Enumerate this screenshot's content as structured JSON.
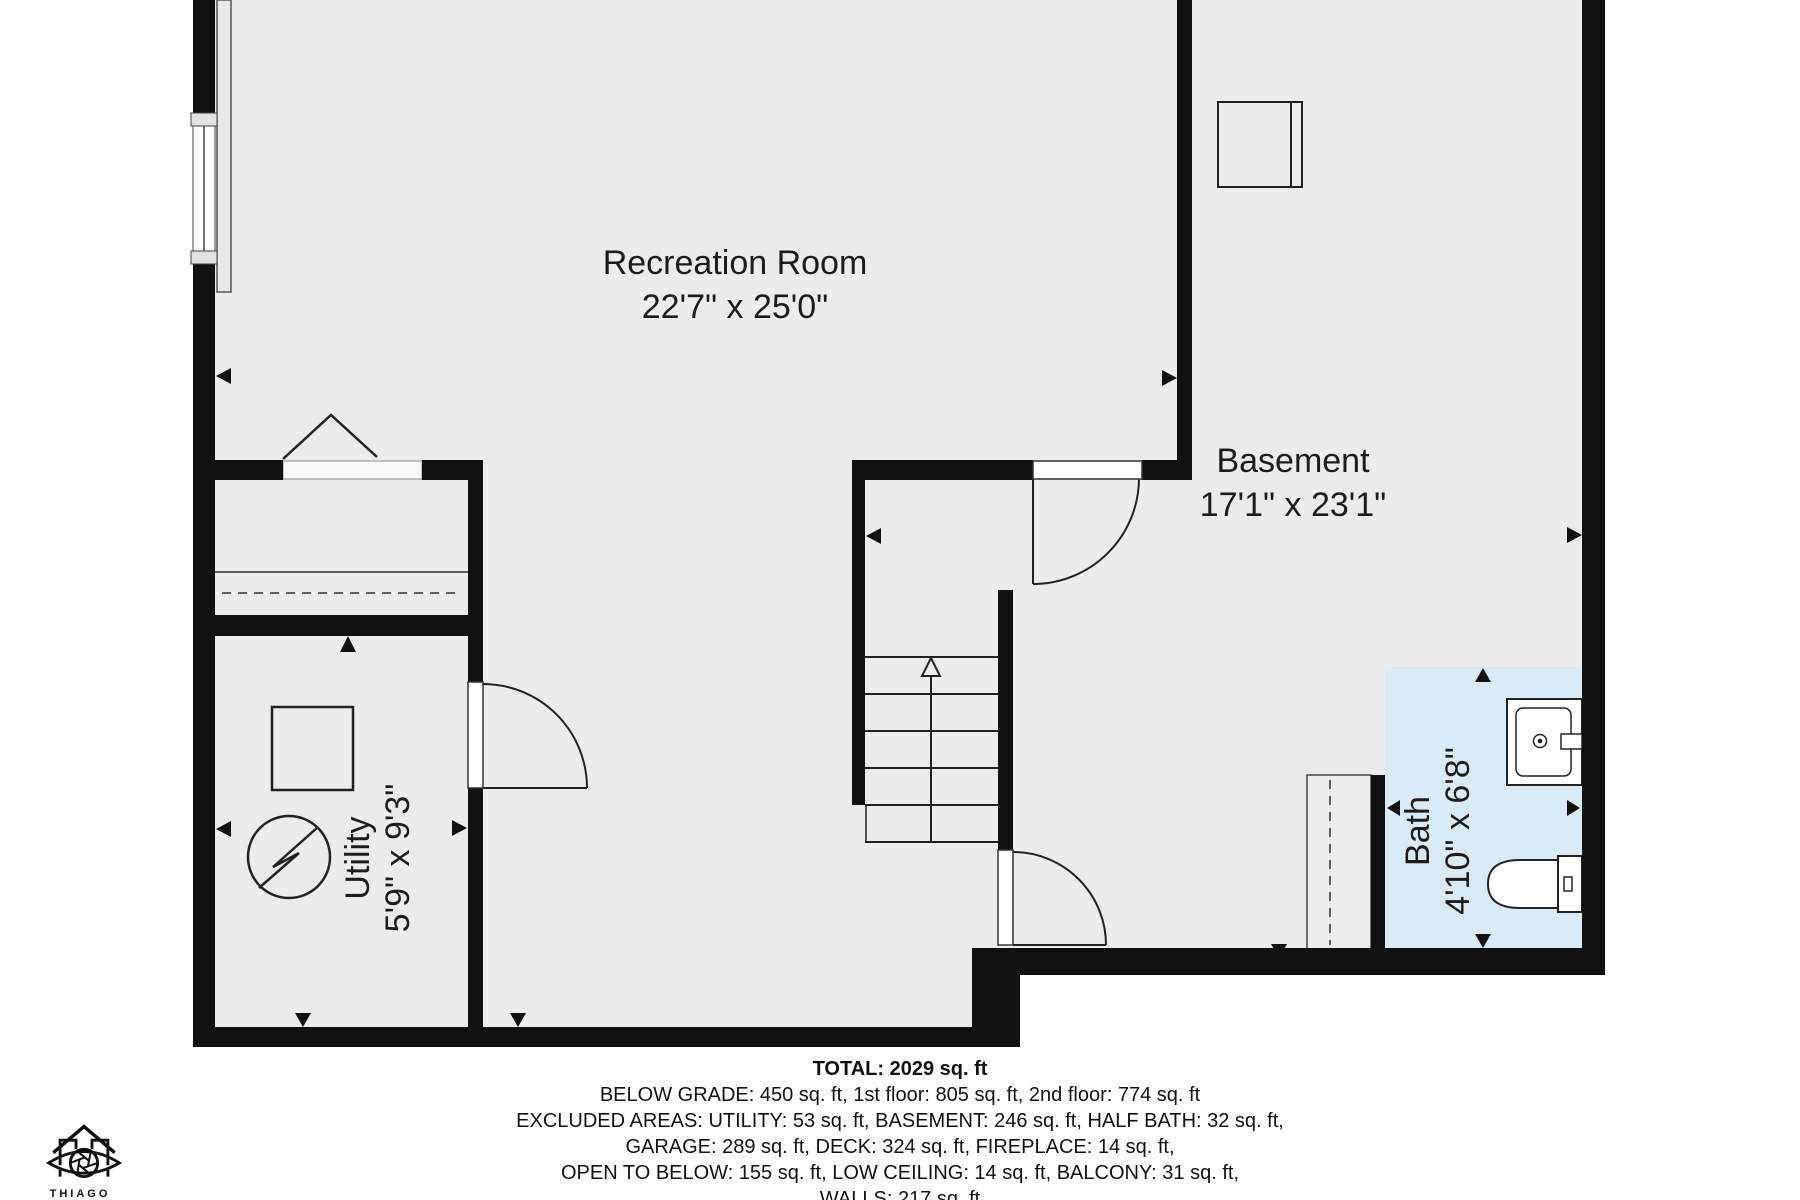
{
  "plan": {
    "rooms": [
      {
        "name": "Recreation Room",
        "dimensions": "22'7\" x 25'0\""
      },
      {
        "name": "Basement",
        "dimensions": "17'1\" x 23'1\""
      },
      {
        "name": "Utility",
        "dimensions": "5'9\" x 9'3\""
      },
      {
        "name": "Bath",
        "dimensions": "4'10\" x 6'8\""
      }
    ],
    "summary": {
      "total": "TOTAL: 2029 sq. ft",
      "line2": "BELOW GRADE: 450 sq. ft, 1st floor: 805 sq. ft, 2nd floor: 774 sq. ft",
      "line3": "EXCLUDED AREAS: UTILITY: 53 sq. ft, BASEMENT: 246 sq. ft, HALF BATH: 32 sq. ft,",
      "line4": "GARAGE: 289 sq. ft, DECK: 324 sq. ft, FIREPLACE: 14 sq. ft,",
      "line5": "OPEN TO BELOW: 155 sq. ft, LOW CEILING: 14 sq. ft, BALCONY: 31 sq. ft,",
      "line6": "WALLS: 217 sq. ft"
    },
    "branding": {
      "logo_text": "THIAGO"
    },
    "colors": {
      "wall": "#111111",
      "floor": "#ececec",
      "bath_floor": "#d9ebf7",
      "line": "#222222",
      "background": "#ffffff"
    },
    "fixtures": [
      "window",
      "fireplace",
      "closet-dashed-rod",
      "stairs-up",
      "door",
      "electrical-panel",
      "furnace-fan",
      "duct-unit",
      "support-post",
      "sink",
      "toilet"
    ]
  }
}
